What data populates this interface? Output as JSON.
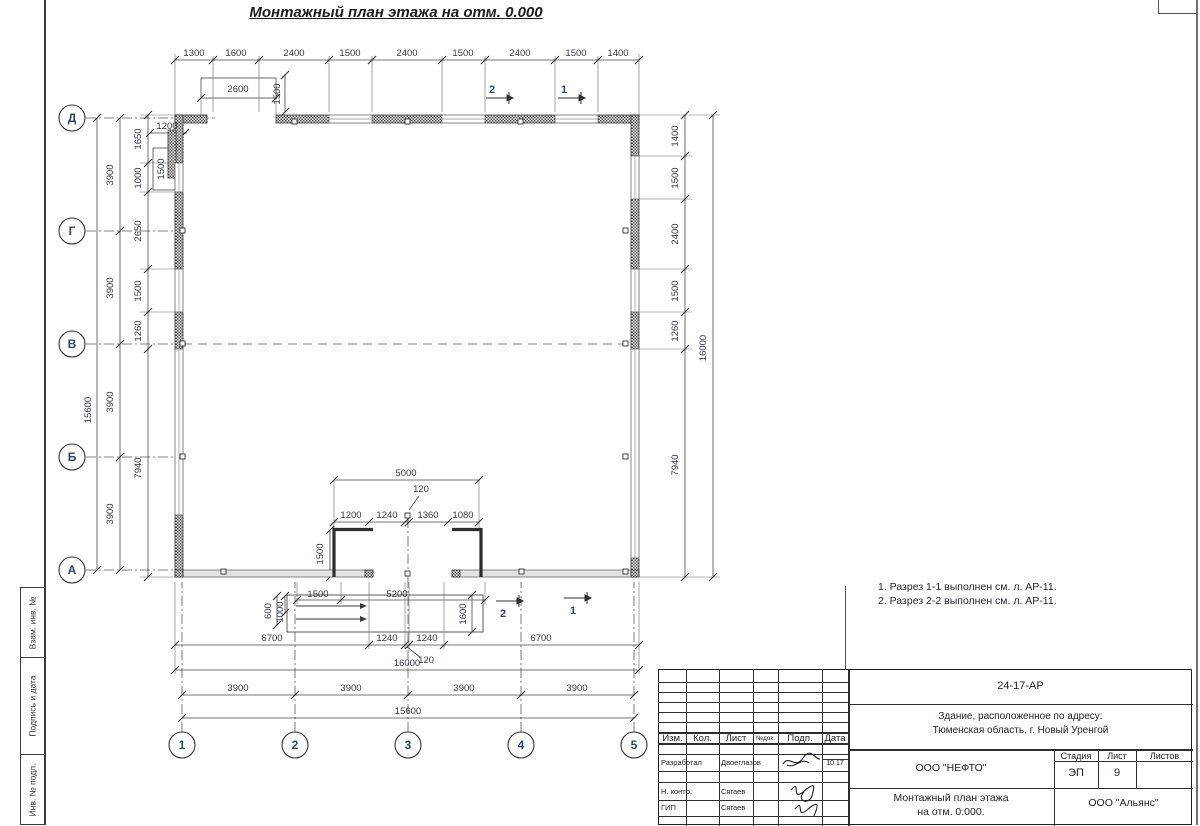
{
  "title": "Монтажный план этажа на отм. 0.000",
  "notes": {
    "line1": "1. Разрез 1-1 выполнен см. л. АР-11.",
    "line2": "2. Разрез 2-2 выполнен см. л. АР-11."
  },
  "side_strip": {
    "box1": "Взам. инв. №",
    "box2": "Подпись и дата",
    "box3": "Инв. № подл."
  },
  "plan": {
    "row_axes": [
      {
        "label": "Д",
        "y": 118
      },
      {
        "label": "Г",
        "y": 231
      },
      {
        "label": "В",
        "y": 344
      },
      {
        "label": "Б",
        "y": 457
      },
      {
        "label": "А",
        "y": 570
      }
    ],
    "col_axes": [
      {
        "label": "1",
        "x": 182
      },
      {
        "label": "2",
        "x": 295
      },
      {
        "label": "3",
        "x": 408
      },
      {
        "label": "4",
        "x": 521
      },
      {
        "label": "5",
        "x": 634
      }
    ],
    "section_markers": [
      {
        "t": "2",
        "x": 492,
        "y": 93
      },
      {
        "t": "1",
        "x": 564,
        "y": 93
      },
      {
        "t": "2",
        "x": 503,
        "y": 617
      },
      {
        "t": "1",
        "x": 573,
        "y": 614
      }
    ],
    "dim_labels": [
      {
        "t": "1300",
        "x": 194,
        "y": 56
      },
      {
        "t": "1600",
        "x": 236,
        "y": 56
      },
      {
        "t": "2400",
        "x": 294,
        "y": 56
      },
      {
        "t": "1500",
        "x": 350,
        "y": 56
      },
      {
        "t": "2400",
        "x": 407,
        "y": 56
      },
      {
        "t": "1500",
        "x": 463,
        "y": 56
      },
      {
        "t": "2400",
        "x": 520,
        "y": 56
      },
      {
        "t": "1500",
        "x": 576,
        "y": 56
      },
      {
        "t": "1400",
        "x": 618,
        "y": 56
      },
      {
        "t": "2600",
        "x": 238,
        "y": 92
      },
      {
        "t": "1500",
        "x": 280,
        "y": 94,
        "r": -90
      },
      {
        "t": "15600",
        "x": 91,
        "y": 410,
        "r": -90
      },
      {
        "t": "3900",
        "x": 113,
        "y": 175,
        "r": -90
      },
      {
        "t": "3900",
        "x": 113,
        "y": 288,
        "r": -90
      },
      {
        "t": "3900",
        "x": 113,
        "y": 402,
        "r": -90
      },
      {
        "t": "3900",
        "x": 113,
        "y": 514,
        "r": -90
      },
      {
        "t": "1650",
        "x": 141,
        "y": 139,
        "r": -90
      },
      {
        "t": "1000",
        "x": 141,
        "y": 178,
        "r": -90
      },
      {
        "t": "2650",
        "x": 141,
        "y": 231,
        "r": -90
      },
      {
        "t": "1500",
        "x": 141,
        "y": 291,
        "r": -90
      },
      {
        "t": "1260",
        "x": 141,
        "y": 331,
        "r": -90
      },
      {
        "t": "7940",
        "x": 141,
        "y": 468,
        "r": -90
      },
      {
        "t": "1200",
        "x": 167,
        "y": 129
      },
      {
        "t": "1500",
        "x": 164,
        "y": 169,
        "r": -90
      },
      {
        "t": "1400",
        "x": 678,
        "y": 136,
        "r": -90
      },
      {
        "t": "1500",
        "x": 678,
        "y": 178,
        "r": -90
      },
      {
        "t": "2400",
        "x": 678,
        "y": 234,
        "r": -90
      },
      {
        "t": "1500",
        "x": 678,
        "y": 291,
        "r": -90
      },
      {
        "t": "1260",
        "x": 678,
        "y": 331,
        "r": -90
      },
      {
        "t": "7940",
        "x": 678,
        "y": 465,
        "r": -90
      },
      {
        "t": "16000",
        "x": 706,
        "y": 348,
        "r": -90
      },
      {
        "t": "5000",
        "x": 406,
        "y": 476
      },
      {
        "t": "120",
        "x": 421,
        "y": 492
      },
      {
        "t": "1200",
        "x": 351,
        "y": 518
      },
      {
        "t": "1240",
        "x": 387,
        "y": 518
      },
      {
        "t": "1360",
        "x": 428,
        "y": 518
      },
      {
        "t": "1080",
        "x": 463,
        "y": 518
      },
      {
        "t": "1500",
        "x": 323,
        "y": 554,
        "r": -90
      },
      {
        "t": "1500",
        "x": 318,
        "y": 597
      },
      {
        "t": "5200",
        "x": 397,
        "y": 597
      },
      {
        "t": "600",
        "x": 271,
        "y": 611,
        "r": -90
      },
      {
        "t": "1000",
        "x": 283,
        "y": 612,
        "r": -90
      },
      {
        "t": "1600",
        "x": 466,
        "y": 614,
        "r": -90
      },
      {
        "t": "6700",
        "x": 272,
        "y": 641
      },
      {
        "t": "1240",
        "x": 387,
        "y": 641
      },
      {
        "t": "1240",
        "x": 427,
        "y": 641
      },
      {
        "t": "6700",
        "x": 541,
        "y": 641
      },
      {
        "t": "120",
        "x": 426,
        "y": 663
      },
      {
        "t": "16000",
        "x": 407,
        "y": 666
      },
      {
        "t": "3900",
        "x": 238,
        "y": 691
      },
      {
        "t": "3900",
        "x": 351,
        "y": 691
      },
      {
        "t": "3900",
        "x": 464,
        "y": 691
      },
      {
        "t": "3900",
        "x": 577,
        "y": 691
      },
      {
        "t": "15600",
        "x": 408,
        "y": 714
      }
    ]
  },
  "title_block": {
    "doc_code": "24-17-АР",
    "address_line1": "Здание, расположенное по адресу:",
    "address_line2": "Тюменская область, г. Новый Уренгой",
    "header_cols": {
      "c1": "Изм.",
      "c2": "Кол.",
      "c3": "Лист",
      "c4": "№док.",
      "c5": "Подп.",
      "c6": "Дата"
    },
    "row_developed_role": "Разработал",
    "row_developed_name": "Двоеглазов",
    "row_developed_date": "10.17",
    "row_ncontrol_role": "Н. контр.",
    "row_ncontrol_name": "Сягаев",
    "row_gip_role": "ГИП",
    "row_gip_name": "Сягаев",
    "company": "ООО \"НЕФТО\"",
    "stage_label": "Стадия",
    "sheet_label": "Лист",
    "sheets_label": "Листов",
    "stage_value": "ЭП",
    "sheet_value": "9",
    "sheets_value": "",
    "doc_title_line1": "Монтажный план этажа",
    "doc_title_line2": "на отм. 0.000.",
    "org": "ООО \"Альянс\""
  }
}
